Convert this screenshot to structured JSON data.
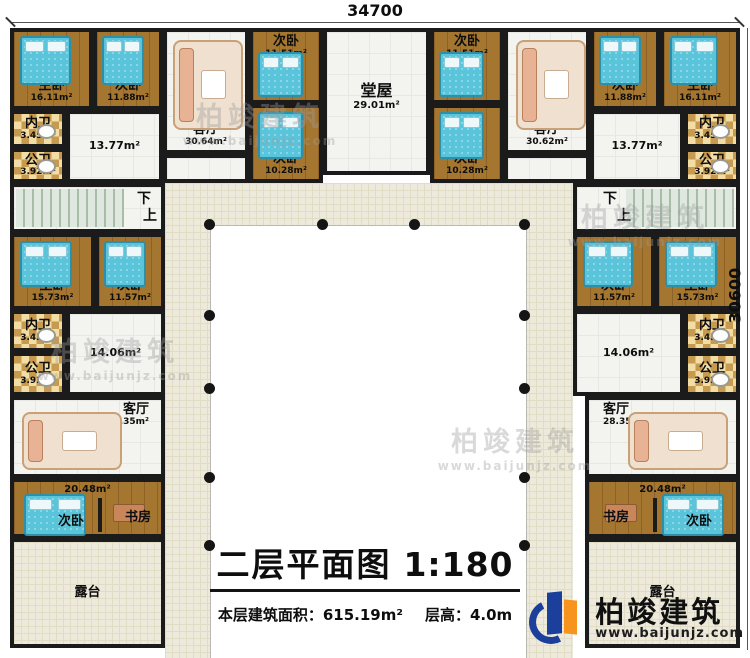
{
  "dimensions": {
    "top": "34700",
    "right": "30600"
  },
  "title": {
    "main": "二层平面图",
    "scale": "1:180",
    "area_label": "本层建筑面积：",
    "area_value": "615.19m²",
    "floor_height_label": "层高：",
    "floor_height_value": "4.0m"
  },
  "logo": {
    "name": "柏竣建筑",
    "url": "www.baijunjz.com"
  },
  "watermark": {
    "name": "柏竣建筑",
    "url": "www.baijunjz.com"
  },
  "stairs": {
    "down": "下",
    "up": "上"
  },
  "top_left": {
    "master": {
      "label": "主卧",
      "area": "16.11m²"
    },
    "bed2": {
      "label": "次卧",
      "area": "11.88m²"
    },
    "living": {
      "label": "客厅",
      "area": "30.64m²"
    },
    "bed3": {
      "label": "次卧",
      "area": "11.51m²"
    },
    "bed4": {
      "label": "次卧",
      "area": "10.28m²"
    },
    "wc_inner": {
      "label": "内卫",
      "area": "3.45m²"
    },
    "wc_public": {
      "label": "公卫",
      "area": "3.92m²"
    },
    "hallway_area": "13.77m²"
  },
  "center_hall": {
    "label": "堂屋",
    "area": "29.01m²"
  },
  "top_right": {
    "bed3": {
      "label": "次卧",
      "area": "11.51m²"
    },
    "bed4": {
      "label": "次卧",
      "area": "10.28m²"
    },
    "living": {
      "label": "客厅",
      "area": "30.62m²"
    },
    "bed2": {
      "label": "次卧",
      "area": "11.88m²"
    },
    "master": {
      "label": "主卧",
      "area": "16.11m²"
    },
    "wc_inner": {
      "label": "内卫",
      "area": "3.45m²"
    },
    "wc_public": {
      "label": "公卫",
      "area": "3.92m²"
    },
    "hallway_area": "13.77m²"
  },
  "left_wing": {
    "master": {
      "label": "主卧",
      "area": "15.73m²"
    },
    "bed": {
      "label": "次卧",
      "area": "11.57m²"
    },
    "wc_inner": {
      "label": "内卫",
      "area": "3.45m²"
    },
    "wc_public": {
      "label": "公卫",
      "area": "3.92m²"
    },
    "hallway_area": "14.06m²",
    "living": {
      "label": "客厅",
      "area": "28.35m²"
    },
    "suite": {
      "area": "20.48m²",
      "bed_label": "次卧",
      "study_label": "书房"
    },
    "terrace": "露台"
  },
  "right_wing": {
    "bed": {
      "label": "次卧",
      "area": "11.57m²"
    },
    "master": {
      "label": "主卧",
      "area": "15.73m²"
    },
    "wc_inner": {
      "label": "内卫",
      "area": "3.45m²"
    },
    "wc_public": {
      "label": "公卫",
      "area": "3.92m²"
    },
    "hallway_area": "14.06m²",
    "living": {
      "label": "客厅",
      "area": "28.35m²"
    },
    "suite": {
      "area": "20.48m²",
      "study_label": "书房",
      "bed_label": "次卧"
    },
    "terrace": "露台"
  }
}
